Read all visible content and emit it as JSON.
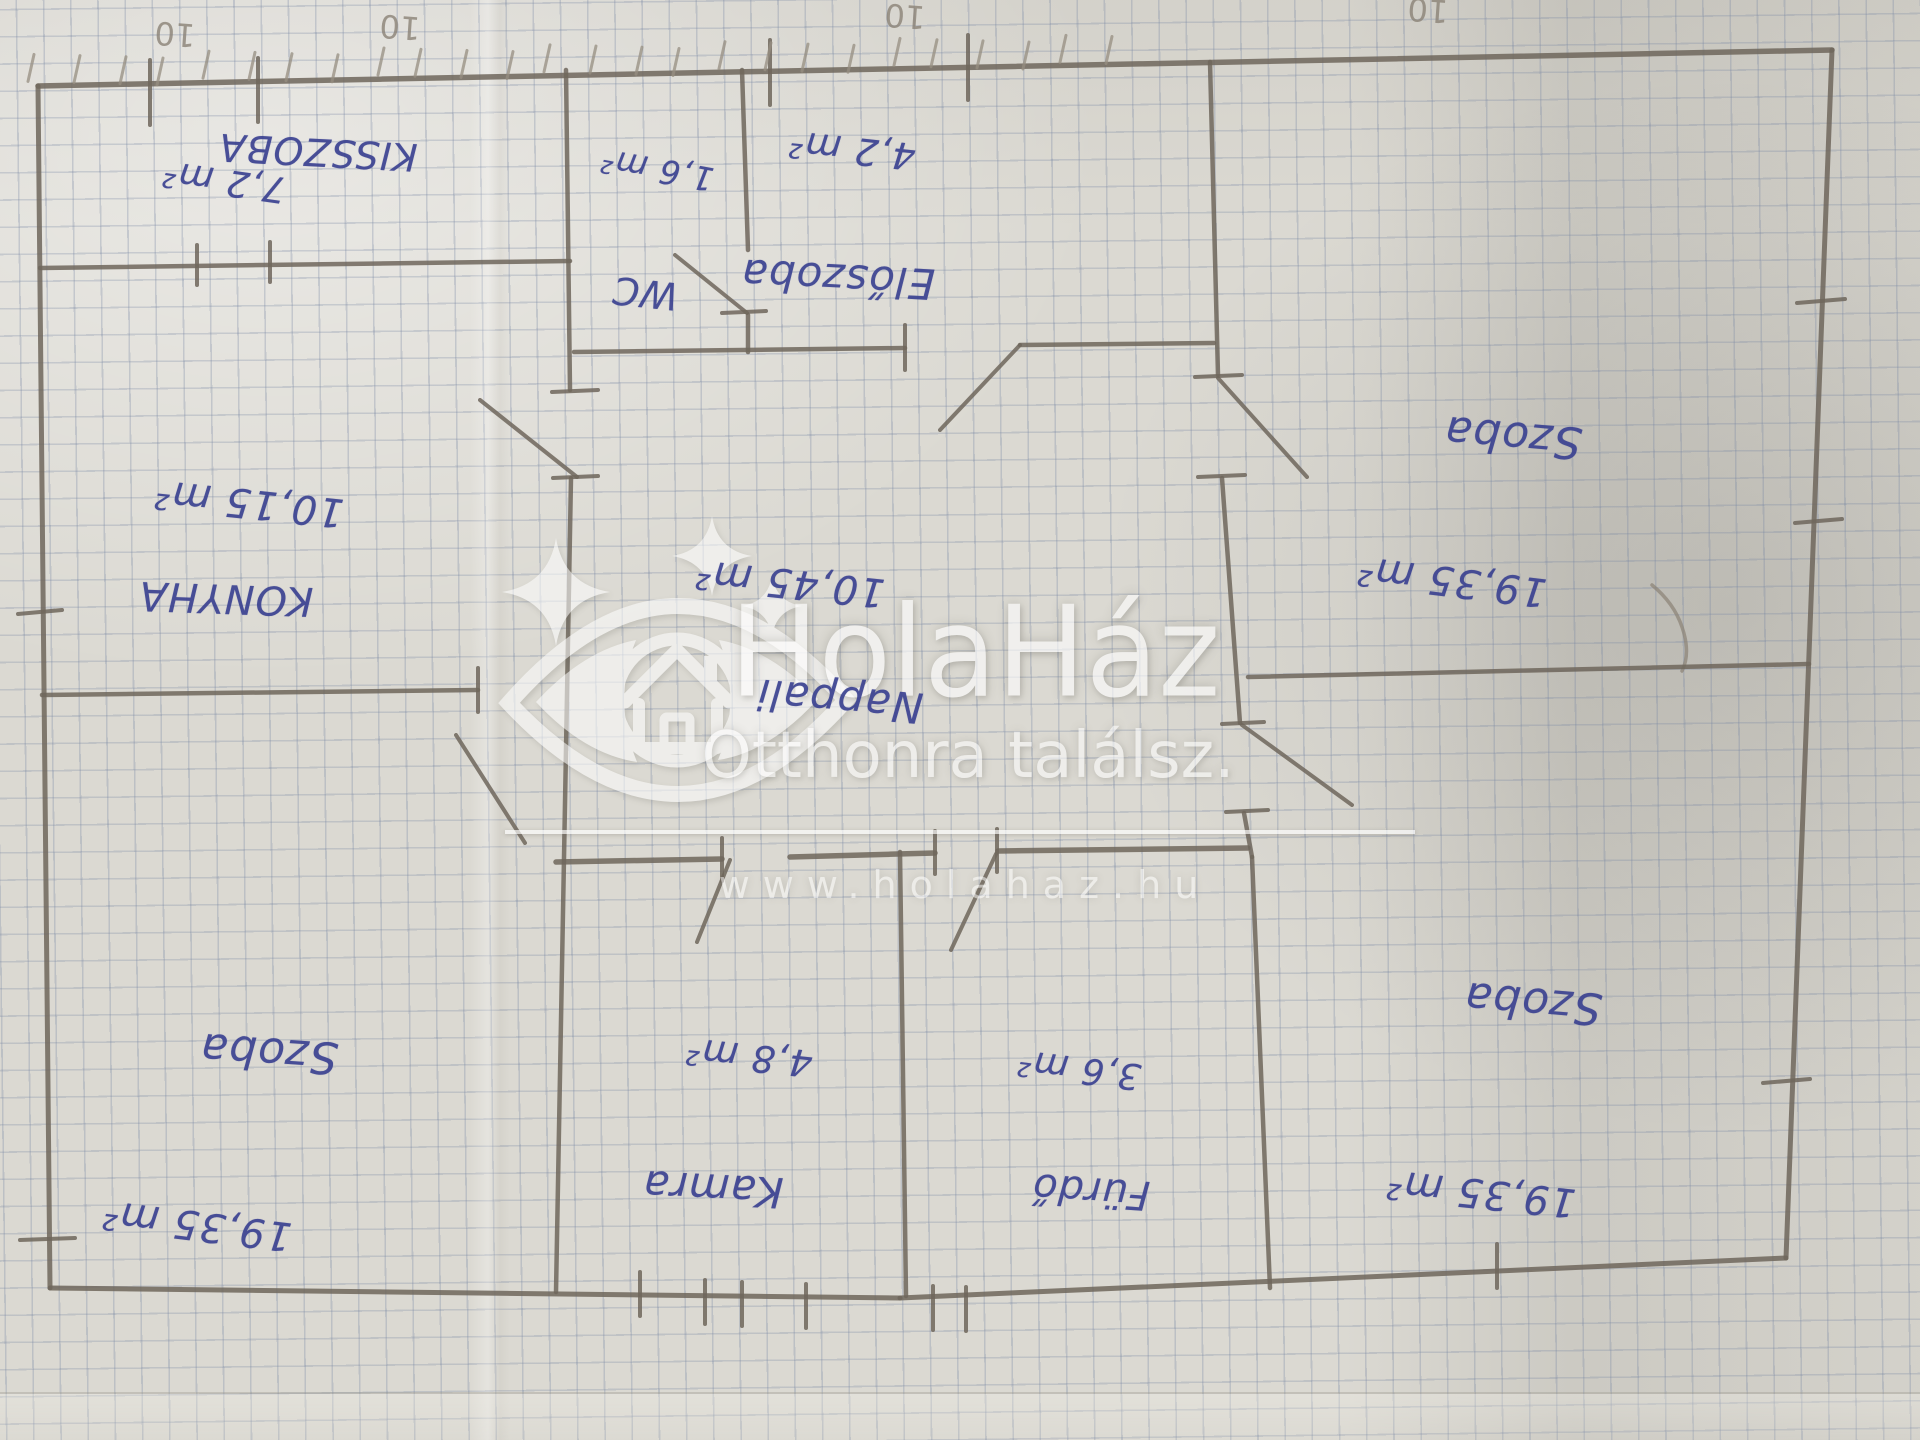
{
  "watermark": {
    "brand": "HolaHáz",
    "tagline": "Otthonra találsz.",
    "url": "www.holahaz.hu"
  },
  "colors": {
    "ink": "#3b4291",
    "pencil": "#6f675c",
    "pencil_light": "#968e81",
    "paper": "#dbd9d2",
    "watermark": "#ffffff"
  },
  "rooms": [
    {
      "id": "kisszoba",
      "name": "KISSZOBA",
      "area": "7,2 m²",
      "name_pos": [
        318,
        152
      ],
      "name_size": 38,
      "name_rot": 183,
      "area_pos": [
        224,
        181
      ],
      "area_size": 36,
      "area_rot": 188
    },
    {
      "id": "wc",
      "name": "WC",
      "area": "1,6 m²",
      "name_pos": [
        645,
        293
      ],
      "name_size": 38,
      "name_rot": 186,
      "area_pos": [
        657,
        170
      ],
      "area_size": 33,
      "area_rot": 190
    },
    {
      "id": "eloszoba",
      "name": "Előszoba",
      "area": "4,2 m²",
      "name_pos": [
        838,
        279
      ],
      "name_size": 42,
      "name_rot": 183,
      "area_pos": [
        852,
        150
      ],
      "area_size": 37,
      "area_rot": 186
    },
    {
      "id": "szoba-tr",
      "name": "Szoba",
      "area": "19,35 m²",
      "name_pos": [
        1513,
        437
      ],
      "name_size": 44,
      "name_rot": 185,
      "area_pos": [
        1452,
        581
      ],
      "area_size": 40,
      "area_rot": 187
    },
    {
      "id": "konyha",
      "name": "KONYHA",
      "area": "10,15 m²",
      "name_pos": [
        226,
        598
      ],
      "name_size": 40,
      "name_rot": 182,
      "area_pos": [
        249,
        503
      ],
      "area_size": 40,
      "area_rot": 186
    },
    {
      "id": "nappali",
      "name": "Nappali",
      "area": "10,45 m²",
      "name_pos": [
        840,
        701
      ],
      "name_size": 42,
      "name_rot": 185,
      "area_pos": [
        790,
        583
      ],
      "area_size": 40,
      "area_rot": 186
    },
    {
      "id": "szoba-bl",
      "name": "Szoba",
      "area": "19,35 m²",
      "name_pos": [
        269,
        1053
      ],
      "name_size": 44,
      "name_rot": 184,
      "area_pos": [
        197,
        1225
      ],
      "area_size": 40,
      "area_rot": 187
    },
    {
      "id": "kamra",
      "name": "Kamra",
      "area": "4,8 m²",
      "name_pos": [
        713,
        1189
      ],
      "name_size": 42,
      "name_rot": 183,
      "area_pos": [
        749,
        1057
      ],
      "area_size": 37,
      "area_rot": 186
    },
    {
      "id": "furdo",
      "name": "Fürdő",
      "area": "3,6 m²",
      "name_pos": [
        1091,
        1191
      ],
      "name_size": 40,
      "name_rot": 184,
      "area_pos": [
        1079,
        1069
      ],
      "area_size": 36,
      "area_rot": 187
    },
    {
      "id": "szoba-br",
      "name": "Szoba",
      "area": "19,35 m²",
      "name_pos": [
        1533,
        1003
      ],
      "name_size": 44,
      "name_rot": 185,
      "area_pos": [
        1481,
        1193
      ],
      "area_size": 40,
      "area_rot": 186
    }
  ],
  "pencil_notes": [
    {
      "text": "10",
      "x": 175,
      "y": 34
    },
    {
      "text": "10",
      "x": 400,
      "y": 27
    },
    {
      "text": "10",
      "x": 905,
      "y": 16
    },
    {
      "text": "10",
      "x": 1428,
      "y": 10
    }
  ],
  "plan": {
    "walls": [
      [
        38,
        86,
        1832,
        50,
        5.5
      ],
      [
        38,
        86,
        50,
        1288,
        5
      ],
      [
        50,
        1288,
        900,
        1298,
        5
      ],
      [
        900,
        1298,
        1786,
        1258,
        5
      ],
      [
        1832,
        50,
        1786,
        1258,
        5
      ],
      [
        40,
        268,
        570,
        261,
        4.5
      ],
      [
        566,
        70,
        570,
        390,
        4.5
      ],
      [
        571,
        478,
        556,
        1292,
        4.5
      ],
      [
        574,
        352,
        905,
        348,
        4.5
      ],
      [
        1020,
        345,
        1214,
        343,
        4.5
      ],
      [
        742,
        70,
        748,
        250,
        4.5
      ],
      [
        748,
        315,
        748,
        352,
        4.5
      ],
      [
        1210,
        62,
        1218,
        375,
        4.5
      ],
      [
        1222,
        478,
        1240,
        723,
        4.5
      ],
      [
        1244,
        813,
        1252,
        857,
        4.5
      ],
      [
        1252,
        857,
        1270,
        1288,
        4.5
      ],
      [
        42,
        695,
        478,
        690,
        4.5
      ],
      [
        556,
        862,
        722,
        859,
        5.5
      ],
      [
        790,
        857,
        935,
        853,
        5.5
      ],
      [
        998,
        851,
        1248,
        848,
        5.5
      ],
      [
        900,
        852,
        906,
        1296,
        4.5
      ],
      [
        1248,
        677,
        1809,
        664,
        4.5
      ]
    ],
    "doors": [
      [
        747,
        313,
        675,
        255
      ],
      [
        1020,
        345,
        940,
        430
      ],
      [
        1218,
        378,
        1307,
        477
      ],
      [
        480,
        400,
        577,
        477
      ],
      [
        456,
        735,
        525,
        843
      ],
      [
        730,
        860,
        697,
        942
      ],
      [
        996,
        854,
        951,
        950
      ],
      [
        1242,
        725,
        1352,
        805
      ]
    ],
    "ticks": [
      [
        150,
        60,
        150,
        125
      ],
      [
        258,
        58,
        258,
        122
      ],
      [
        770,
        40,
        770,
        105
      ],
      [
        968,
        35,
        968,
        100
      ],
      [
        197,
        245,
        197,
        285
      ],
      [
        270,
        242,
        270,
        282
      ],
      [
        552,
        392,
        598,
        390
      ],
      [
        553,
        478,
        598,
        476
      ],
      [
        722,
        313,
        766,
        311
      ],
      [
        905,
        325,
        905,
        370
      ],
      [
        1195,
        377,
        1242,
        375
      ],
      [
        1198,
        477,
        1245,
        475
      ],
      [
        1222,
        724,
        1264,
        722
      ],
      [
        1226,
        812,
        1268,
        810
      ],
      [
        478,
        668,
        478,
        712
      ],
      [
        722,
        838,
        722,
        881
      ],
      [
        935,
        831,
        935,
        874
      ],
      [
        997,
        829,
        997,
        872
      ],
      [
        18,
        614,
        62,
        610
      ],
      [
        20,
        1240,
        75,
        1238
      ],
      [
        1797,
        303,
        1845,
        299
      ],
      [
        1795,
        523,
        1842,
        519
      ],
      [
        1763,
        1083,
        1810,
        1079
      ],
      [
        640,
        1272,
        640,
        1316
      ],
      [
        705,
        1280,
        705,
        1324
      ],
      [
        742,
        1282,
        742,
        1326
      ],
      [
        806,
        1284,
        806,
        1328
      ],
      [
        933,
        1286,
        933,
        1330
      ],
      [
        966,
        1287,
        966,
        1331
      ],
      [
        1497,
        1244,
        1497,
        1288
      ]
    ],
    "tally": {
      "count": 26,
      "x_start": 30,
      "x_step": 43,
      "y_at_left": 82,
      "slope": -0.0185,
      "length": 27
    }
  }
}
